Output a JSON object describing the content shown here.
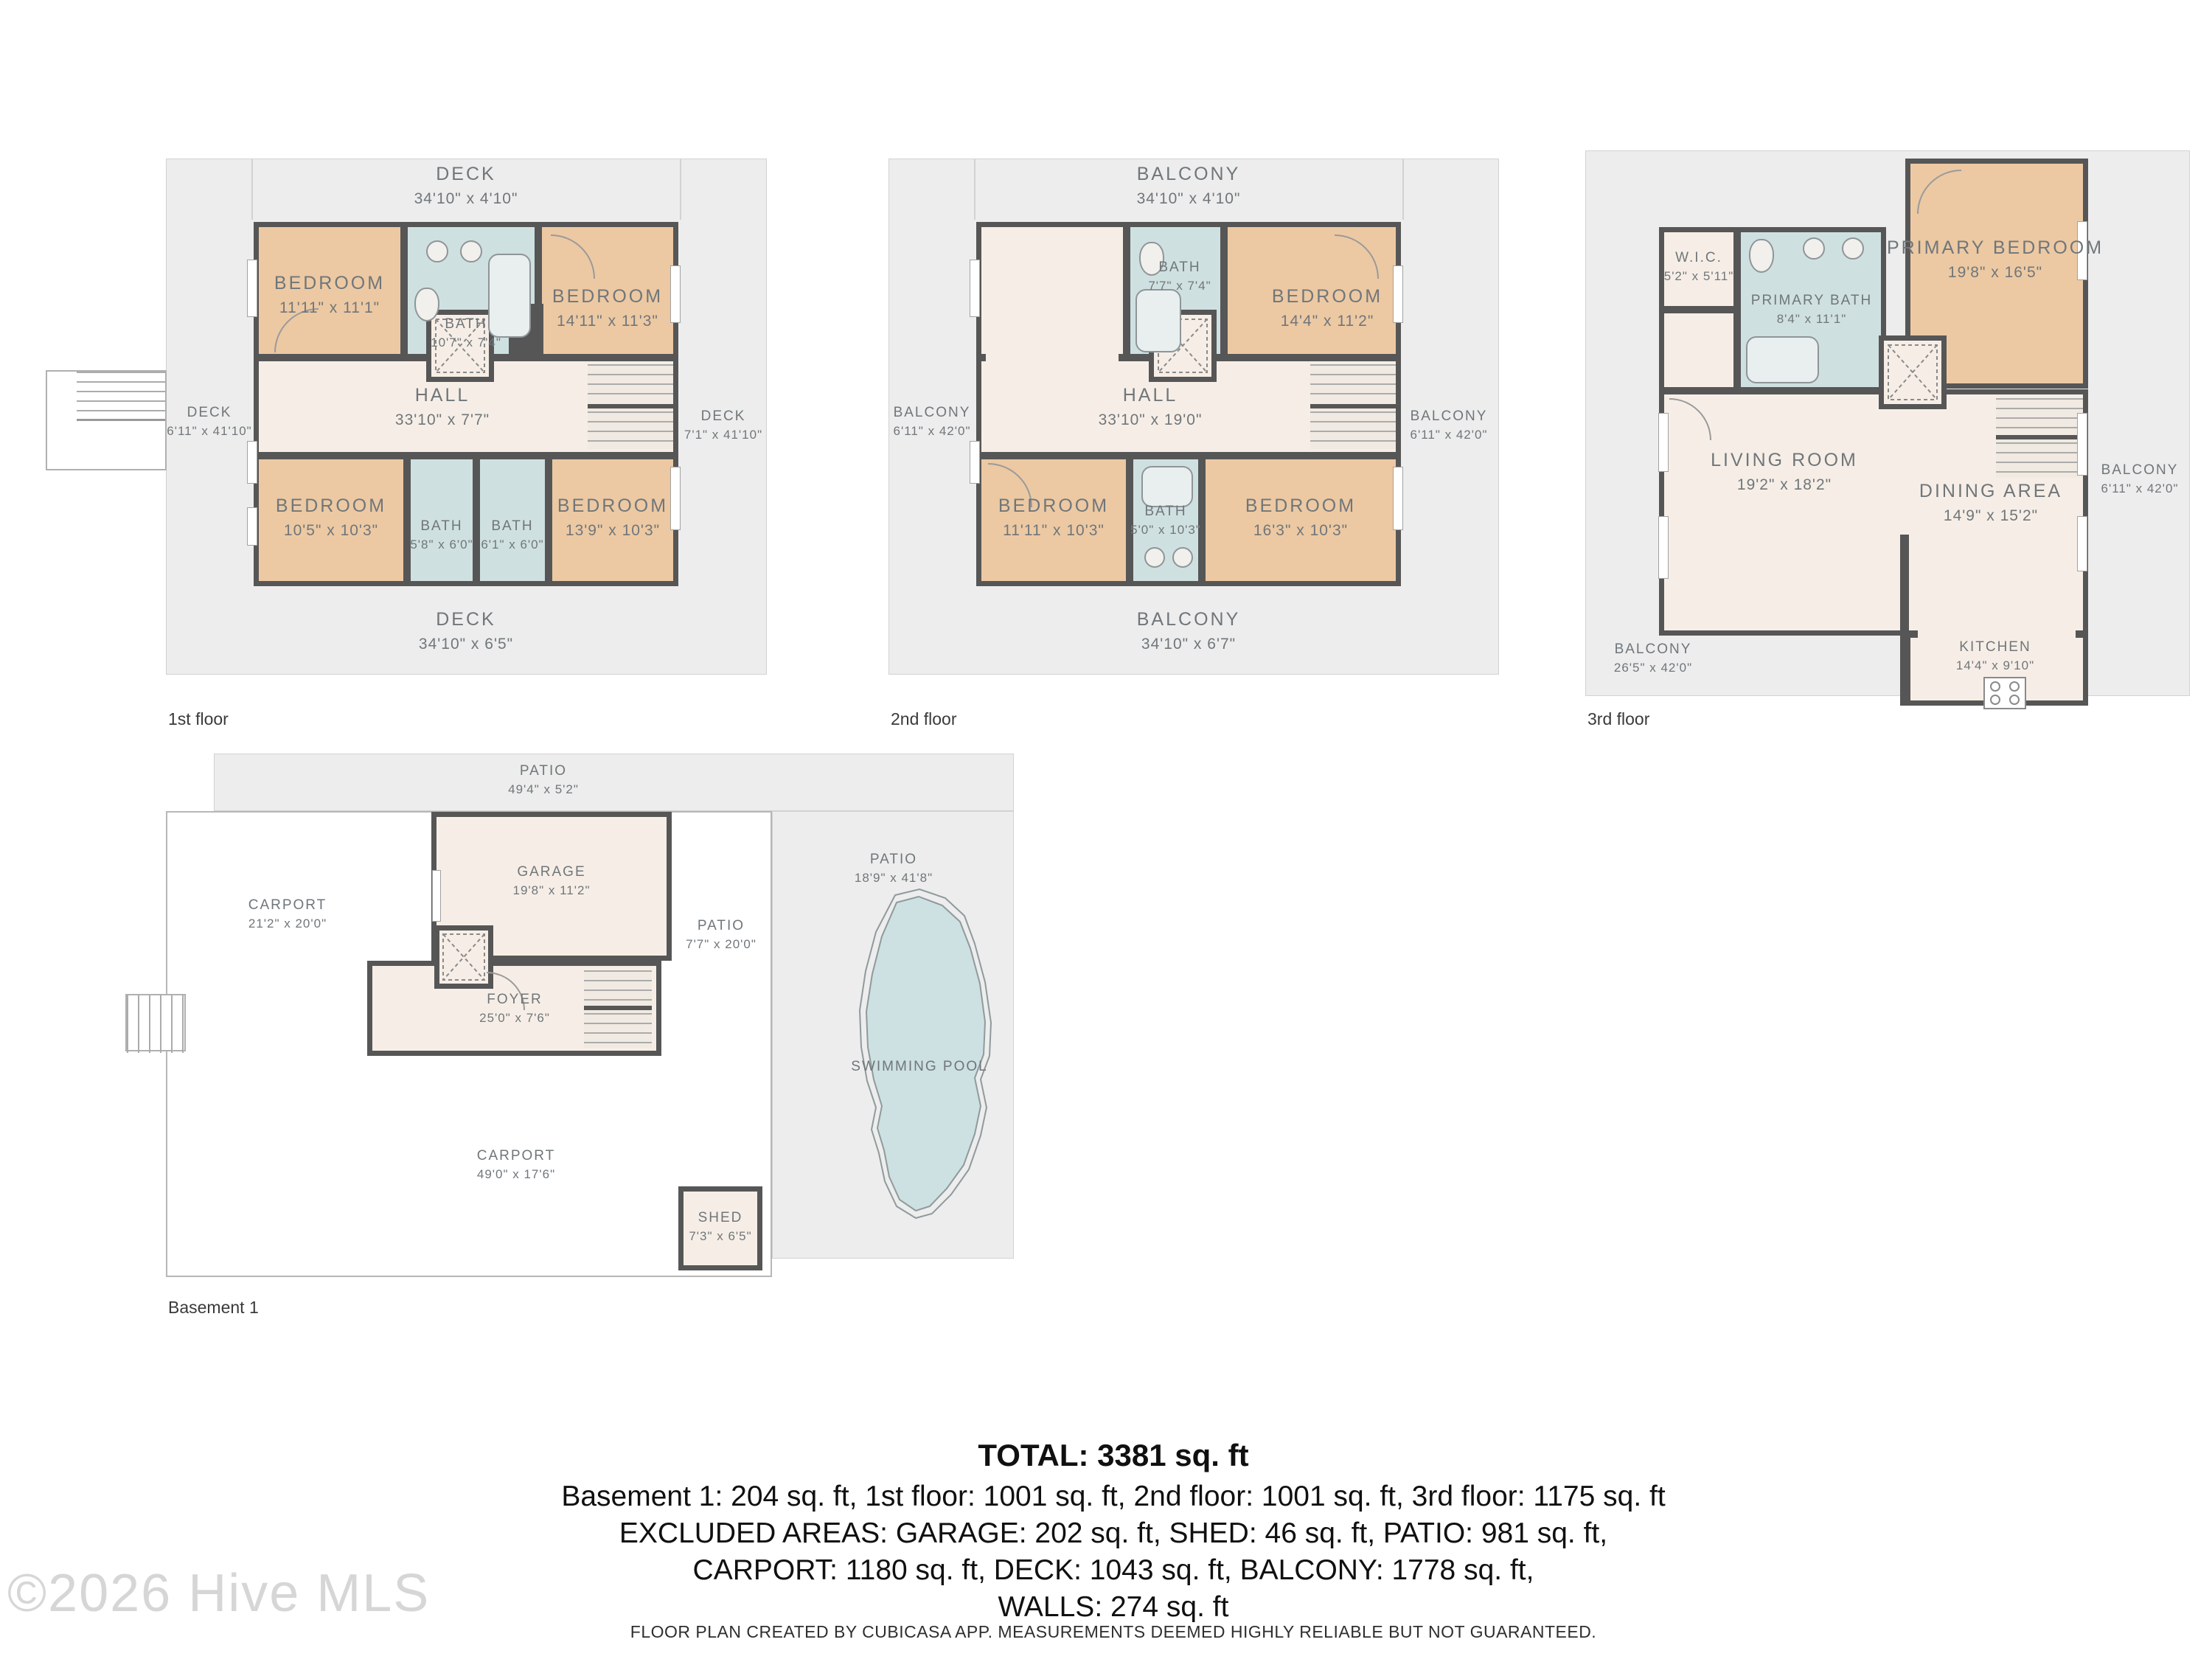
{
  "watermark": "©2026 Hive MLS",
  "footer": "FLOOR PLAN CREATED BY CUBICASA APP. MEASUREMENTS DEEMED HIGHLY RELIABLE BUT NOT GUARANTEED.",
  "summary": {
    "total": "TOTAL: 3381 sq. ft",
    "line1": "Basement 1: 204 sq. ft, 1st floor: 1001 sq. ft, 2nd floor: 1001 sq. ft, 3rd floor: 1175 sq. ft",
    "line2": "EXCLUDED AREAS: GARAGE: 202 sq. ft, SHED: 46 sq. ft, PATIO: 981 sq. ft,",
    "line3": "CARPORT: 1180 sq. ft, DECK: 1043 sq. ft, BALCONY: 1778 sq. ft,",
    "line4": "WALLS: 274 sq. ft"
  },
  "colors": {
    "bedroom_fill": "#ecc9a3",
    "bath_fill": "#cfe0e1",
    "floor_fill": "#f6eee6",
    "outdoor_fill": "#ededed",
    "wall": "#565656",
    "pool_fill": "#cde0e2"
  },
  "floors": {
    "first": {
      "label": "1st floor",
      "deck_top": {
        "name": "DECK",
        "dims": "34'10\" x 4'10\""
      },
      "deck_left": {
        "name": "DECK",
        "dims": "6'11\" x 41'10\""
      },
      "deck_right": {
        "name": "DECK",
        "dims": "7'1\" x 41'10\""
      },
      "deck_bottom": {
        "name": "DECK",
        "dims": "34'10\" x 6'5\""
      },
      "bedroom_tl": {
        "name": "BEDROOM",
        "dims": "11'11\" x 11'1\""
      },
      "bath_top": {
        "name": "BATH",
        "dims": "10'7\" x 7'4\""
      },
      "bedroom_tr": {
        "name": "BEDROOM",
        "dims": "14'11\" x 11'3\""
      },
      "hall": {
        "name": "HALL",
        "dims": "33'10\" x 7'7\""
      },
      "bedroom_bl": {
        "name": "BEDROOM",
        "dims": "10'5\" x 10'3\""
      },
      "bath_bl": {
        "name": "BATH",
        "dims": "5'8\" x 6'0\""
      },
      "bath_br": {
        "name": "BATH",
        "dims": "6'1\" x 6'0\""
      },
      "bedroom_br": {
        "name": "BEDROOM",
        "dims": "13'9\" x 10'3\""
      }
    },
    "second": {
      "label": "2nd floor",
      "balcony_top": {
        "name": "BALCONY",
        "dims": "34'10\" x 4'10\""
      },
      "balcony_left": {
        "name": "BALCONY",
        "dims": "6'11\" x 42'0\""
      },
      "balcony_right": {
        "name": "BALCONY",
        "dims": "6'11\" x 42'0\""
      },
      "balcony_bottom": {
        "name": "BALCONY",
        "dims": "34'10\" x 6'7\""
      },
      "bath_top": {
        "name": "BATH",
        "dims": "7'7\" x 7'4\""
      },
      "bedroom_tr": {
        "name": "BEDROOM",
        "dims": "14'4\" x 11'2\""
      },
      "hall": {
        "name": "HALL",
        "dims": "33'10\" x 19'0\""
      },
      "bedroom_bl": {
        "name": "BEDROOM",
        "dims": "11'11\" x 10'3\""
      },
      "bath_bottom": {
        "name": "BATH",
        "dims": "5'0\" x 10'3\""
      },
      "bedroom_br": {
        "name": "BEDROOM",
        "dims": "16'3\" x 10'3\""
      }
    },
    "third": {
      "label": "3rd floor",
      "wic": {
        "name": "W.I.C.",
        "dims": "5'2\" x 5'11\""
      },
      "primary_bath": {
        "name": "PRIMARY BATH",
        "dims": "8'4\" x 11'1\""
      },
      "primary_bedroom": {
        "name": "PRIMARY BEDROOM",
        "dims": "19'8\" x 16'5\""
      },
      "living_room": {
        "name": "LIVING ROOM",
        "dims": "19'2\" x 18'2\""
      },
      "dining_area": {
        "name": "DINING AREA",
        "dims": "14'9\" x 15'2\""
      },
      "kitchen": {
        "name": "KITCHEN",
        "dims": "14'4\" x 9'10\""
      },
      "balcony_right": {
        "name": "BALCONY",
        "dims": "6'11\" x 42'0\""
      },
      "balcony_bottom": {
        "name": "BALCONY",
        "dims": "26'5\" x 42'0\""
      }
    },
    "basement": {
      "label": "Basement 1",
      "patio_top": {
        "name": "PATIO",
        "dims": "49'4\" x 5'2\""
      },
      "carport_upper": {
        "name": "CARPORT",
        "dims": "21'2\" x 20'0\""
      },
      "garage": {
        "name": "GARAGE",
        "dims": "19'8\" x 11'2\""
      },
      "patio_right": {
        "name": "PATIO",
        "dims": "7'7\" x 20'0\""
      },
      "patio_pool": {
        "name": "PATIO",
        "dims": "18'9\" x 41'8\""
      },
      "foyer": {
        "name": "FOYER",
        "dims": "25'0\" x 7'6\""
      },
      "carport_lower": {
        "name": "CARPORT",
        "dims": "49'0\" x 17'6\""
      },
      "shed": {
        "name": "SHED",
        "dims": "7'3\" x 6'5\""
      },
      "pool": {
        "name": "SWIMMING POOL",
        "dims": ""
      }
    }
  }
}
